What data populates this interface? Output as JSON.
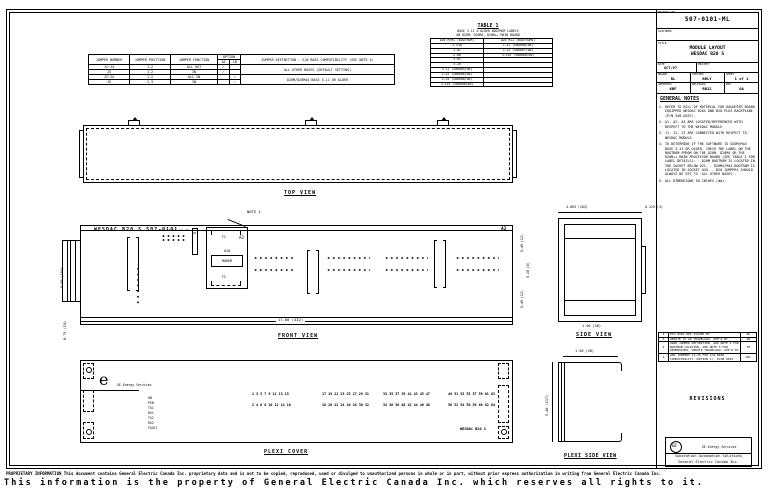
{
  "sheet": {
    "footer": {
      "line1": "PROPRIETARY INFORMATION This document contains General Electric Canada Inc. proprietary data and is not to be copied, reproduced, used or divulged to unauthorized persons in whole or in part, without prior express authorization in writing from General Electric Canada Inc.",
      "line2": "This information is the property of General Electric Canada Inc. which reserves all rights to it."
    }
  },
  "title_block": {
    "drawing_no_label": "DRAWING NO.",
    "drawing_no": "507-0101-ML",
    "customer_label": "CUSTOMER",
    "customer": "",
    "title_label": "TITLE",
    "title_line1": "MODULE LAYOUT",
    "title_line2": "WESDAC B20 S",
    "date_label": "DATE",
    "date": "OCT/97",
    "project_label": "PROJECT",
    "project": "",
    "drawn_label": "DRAWN",
    "drawn": "RL",
    "checked_label": "CHECKED",
    "checked": "BRLY",
    "sheet_label": "SHEET",
    "sheet": "1 of 1",
    "approved_label": "APPROVED",
    "approved": "KBF",
    "released_label": "RELEASED",
    "released": "RB12",
    "rev_label": "REV",
    "rev": "0A"
  },
  "general_notes": {
    "heading": "GENERAL NOTES",
    "notes": [
      "REFER TO BILL OF MATERIAL FOR DAUGHTER BOARD EQUIPPED WESDAC B20S AND B20 PLUS BACKPLANE (P/N 548-0207).",
      "A1, A2, A3 ARE LOCATED/REFERENCED WITH RESPECT TO THE WESDAC MODULE.",
      "J1, J2, J3 ARE CONNECTED WITH RESPECT TO WESDAC MODULE.",
      "TO DETERMINE IF THE SOFTWARE IS D20M/M44 BASE 3.11 OR OLDER, CHECK THE LABEL ON THE BOOTROM EPROM ON THE D20M, D20M4 OR THE D20M++ MAIN PROCESSOR BOARD (SEE TABLE 1 FOR LABEL DETAILS): - D20M BOOTROM IS LOCATED IN THE SOCKET BELOW U21. - D20M4/M44 BOOTROM IS LOCATED IN SOCKET U45. - B20 JUMPERS SHOULD ALWAYS BE SET TO 'ALL OTHER BASES'.",
      "ALL DIMENSIONS IN INCHES (mm)."
    ]
  },
  "jumper_table": {
    "headers": {
      "number": "JUMPER NUMBER",
      "position": "JUMPER POSITION",
      "function": "JUMPER FUNCTION",
      "option": "OPTION",
      "option_a": "1A",
      "option_b": "1B",
      "definition": "JUMPER DEFINITION - S/W BASE COMPATIBILITY (SEE NOTE 4)"
    },
    "rows": [
      {
        "number": "J1~J4",
        "position": "1-2",
        "function": "ALL OUT",
        "a": "✓",
        "b": ""
      },
      {
        "number": "J5",
        "position": "1-2",
        "function": "IN",
        "a": "✓",
        "b": ""
      },
      {
        "number": "J1~J4",
        "position": "1-2",
        "function": "ALL IN",
        "a": "",
        "b": "✓"
      },
      {
        "number": "J5",
        "position": "2-3",
        "function": "IN",
        "a": "",
        "b": "✓"
      }
    ],
    "definitions": [
      "ALL OTHER BASES (DEFAULT SETTING)",
      "D20M/D20M44 BASE 3.11 OR OLDER"
    ]
  },
  "table1": {
    "title": "TABLE 1",
    "subtitle1": "BASE 3.11 & OLDER BOOTROM LABELS",
    "subtitle2": "ON D20M, D20M4, D20M++ MAIN BOARD",
    "col1": "D20 M/M+ (BOOTROM)",
    "col2": "D20 M++ (BOOTROMS)",
    "rows": [
      [
        "3.41B",
        "3.41 (SB8008/08)"
      ],
      [
        "1.01",
        "3.25 (SB8007/08)"
      ],
      [
        "2.00",
        "3.254 (SB8008/80)"
      ],
      [
        "3.01",
        ""
      ],
      [
        "3.20",
        ""
      ],
      [
        "3.21 (SB8004/08)",
        ""
      ],
      [
        "3.22 (SB8006/08)",
        ""
      ],
      [
        "3.25 (SB8008/08)",
        ""
      ],
      [
        "3.254 (SB8008/80)",
        ""
      ]
    ]
  },
  "views": {
    "top": {
      "label": "TOP VIEW"
    },
    "front": {
      "label": "FRONT VIEW",
      "board_title": "WESDAC B20 S 507-0101",
      "a2": "A2",
      "a3": "A3",
      "note1": "NOTE 1",
      "u5": "U5",
      "u10": "U10",
      "modem": "MODEM",
      "f1": "F1",
      "f2": "F2",
      "dim_width": "17.00 (432)",
      "dim_height": "6.50 (164)",
      "dim_offset": "0.75 (19)",
      "dim_r1": "0.48 (12)",
      "dim_r2": "0.28 (6)",
      "dim_r3": "0.48 (12)"
    },
    "side": {
      "label": "SIDE VIEW",
      "dim_top": "4.063 (103)",
      "dim_top_right": "0.125 (3)",
      "dim_bottom": "1.50 (38)"
    },
    "plexi": {
      "label": "PLEXI COVER",
      "brand": "GE Energy Services",
      "logo_glyph": "e",
      "leds": [
        "ON",
        "PSB",
        "TX1",
        "RX1",
        "TX2",
        "RX2",
        "FAULT"
      ],
      "module": "WESDAC B20 S",
      "numbers": {
        "g1o": "1 3 5 7 9 11 13 15",
        "g1e": "2 4 6 8 10 12 14 16",
        "g2o": "17 19 21 23 25 27 29 31",
        "g2e": "18 20 22 24 26 28 30 32",
        "g3o": "33 35 37 39 41 43 45 47",
        "g3e": "34 36 38 40 42 44 46 48",
        "g4o": "49 51 53 55 57 59 61 63",
        "g4e": "50 52 54 56 58 60 62 64"
      }
    },
    "plexi_side": {
      "label": "PLEXI SIDE VIEW",
      "dim_top": "1.50 (38)",
      "dim_left": "5.40 (137)"
    }
  },
  "revisions": {
    "heading": "REVISIONS",
    "rows": [
      {
        "rev": "4",
        "desc": "ECO 0001-005 ISSUED BY",
        "by": "RL"
      },
      {
        "rev": "3",
        "desc": "UPDATE TO GE TRADELOGO. APP'D BY",
        "by": "RV"
      },
      {
        "rev": "2",
        "desc": "SWAP JUMPER DEFINITION, ADD NOTE 4 FOR BOOTROM LOCATION, ADD NOTE 5 FOR DIMENSIONS, UPDATE TRADELOGO. APP'D BY",
        "by": "FP"
      },
      {
        "rev": "1",
        "desc": "ADD JUMPERS J1~J5 FOR S/W BASE COMPATIBILITY (OPTION 1). ECO# 9643",
        "by": "MJL"
      }
    ]
  },
  "ge_block": {
    "monogram": "GE",
    "brand": "GE Energy Services",
    "line1": "Substation Automation Solutions",
    "line2": "General Electric Canada Inc."
  }
}
